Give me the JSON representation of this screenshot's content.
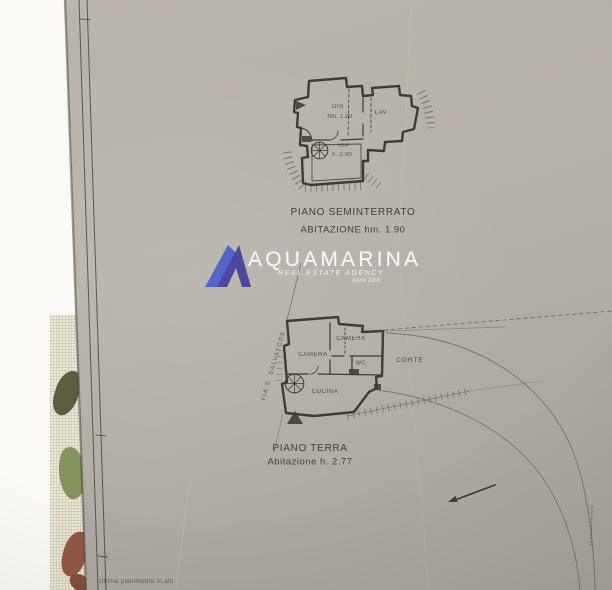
{
  "watermark": {
    "brand": "AQUAMARINA",
    "tagline": "REAL ESTATE AGENCY",
    "since": "since 2000"
  },
  "plans": [
    {
      "title": "PIANO SEMINTERRATO",
      "subtitle": "ABITAZIONE hm. 1.90",
      "rooms": [
        {
          "label": "DIS",
          "height": "hm. 1.80"
        },
        {
          "label": "LAV"
        },
        {
          "label": "RIP",
          "height": "h. 2.00"
        }
      ]
    },
    {
      "title": "PIANO TERRA",
      "subtitle": "Abitazione h. 2.77",
      "street_label": "VIA S. SALVATORE",
      "rooms": [
        {
          "label": "CAMERA"
        },
        {
          "label": "CAMERA"
        },
        {
          "label": "WC"
        },
        {
          "label": "CUCINA"
        },
        {
          "label": "CORTE"
        }
      ]
    }
  ],
  "footer_note": "Ultima planimetria in atti",
  "colors": {
    "paper": "#b6b1a9",
    "ink": "#3f3b35",
    "watermark_blue": "#4a5ccc",
    "watermark_indigo": "#413c9c"
  }
}
